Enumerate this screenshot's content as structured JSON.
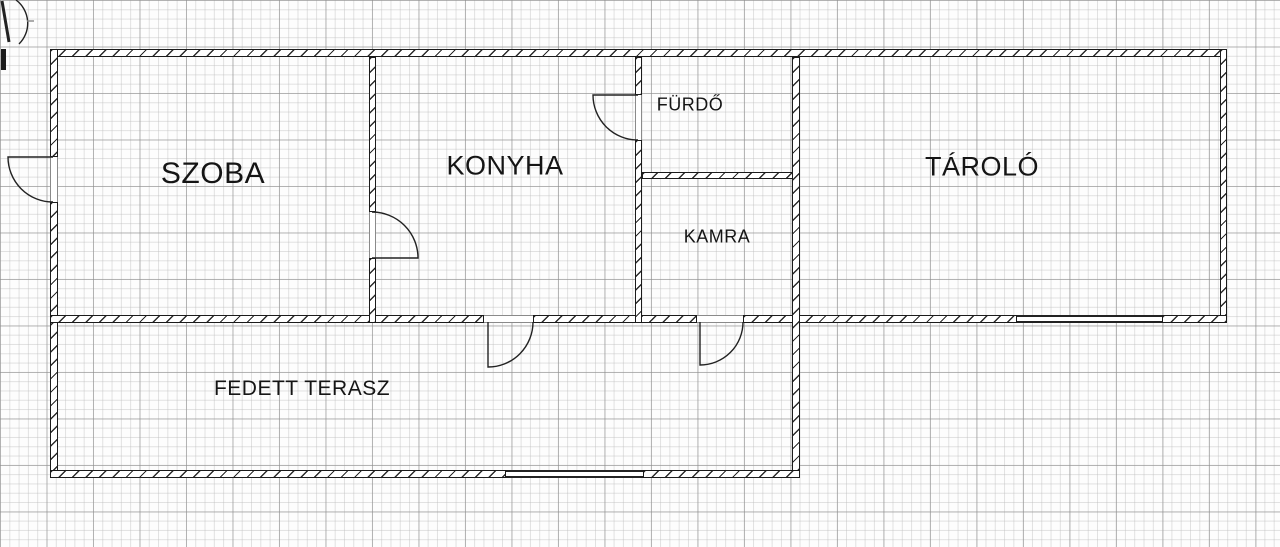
{
  "plan": {
    "rooms": {
      "szoba": "SZOBA",
      "konyha": "KONYHA",
      "furdo": "FÜRDŐ",
      "kamra": "KAMRA",
      "tarolo": "TÁROLÓ",
      "fedett_terasz": "FEDETT TERASZ"
    },
    "symbols": {
      "door_swings": 6,
      "windows": 2
    },
    "colors": {
      "wall_line": "#1b1b1b",
      "hatch": "#2b2b2b",
      "grid_minor": "#bebebe",
      "grid_major": "#8c8c8c",
      "paper": "#fdfdfd",
      "label_text": "#151515"
    }
  }
}
